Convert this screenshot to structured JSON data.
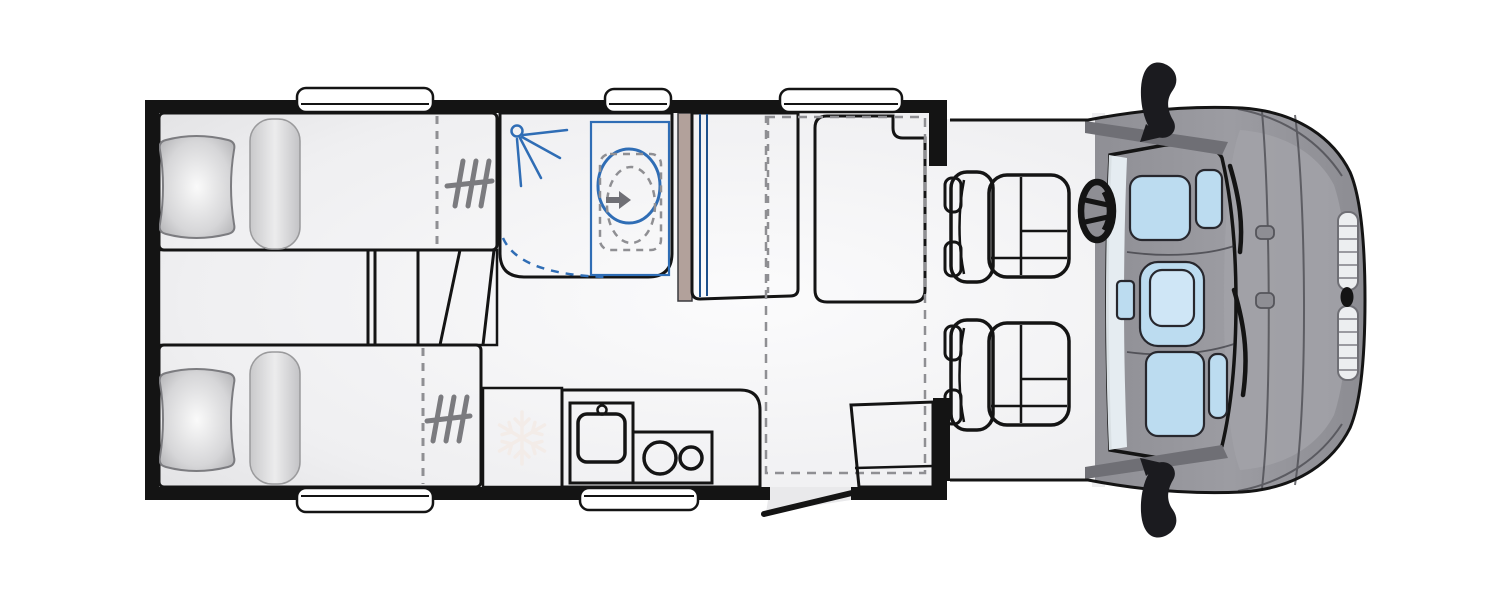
{
  "diagram": {
    "type": "motorhome-floorplan-top-view",
    "features": [
      "rear-twin-bed-top",
      "rear-twin-bed-bottom",
      "pillow",
      "bolster-cushion",
      "bed-steps",
      "bed-extension-dash-line",
      "ladder-icon",
      "shower-room",
      "shower-head-icon",
      "swivel-toilet",
      "toilet-swing-outline",
      "shower-door-swing",
      "wardrobe",
      "rear-bench-seat",
      "drop-down-bed-outline",
      "fridge",
      "snowflake-icon",
      "kitchen-counter",
      "sink",
      "tap",
      "two-burner-hob",
      "entry-door-open",
      "entry-side-seat",
      "driver-swivel-seat",
      "passenger-swivel-seat",
      "steering-wheel-icon",
      "windshield-dashboard",
      "instrument-panel",
      "center-console",
      "wiper-blade-icon",
      "side-mirror-icon",
      "front-grille-icon",
      "brand-badge",
      "window"
    ],
    "window_count": 5,
    "seat_count_cab": 2
  },
  "palette": {
    "bg": "#ffffff",
    "wall": "#141414",
    "line": "#141414",
    "soft_line": "#3a3a3e",
    "floor_hi": "#fbfbfc",
    "floor_lo": "#e0e0e2",
    "mattress_hi": "#f1f1f2",
    "mattress_lo": "#c3c3c6",
    "platform_hi": "#e6e6e8",
    "platform_lo": "#bfbfc3",
    "pillow_hi": "#fafafa",
    "pillow_lo": "#a8a8ab",
    "tan": "#b2a19b",
    "tan_deep": "#a5948e",
    "bath_deep": "#7fbce9",
    "bath_pale": "#eaf5fc",
    "bath_line": "#2f6db5",
    "ward_dark": "#2e6fb2",
    "ward_light": "#82b6e6",
    "seat_dark": "#3f85c9",
    "seat_light": "#7fb2e2",
    "glass_hi": "#ddeefa",
    "glass_lo": "#a9d1ec",
    "dash_item": "#bcdcf0",
    "body_gray": "#97979d",
    "body_hi": "#a6a6ac",
    "body_dark": "#6f6f75",
    "body_line": "#4d4d53",
    "grille": "#eceef0",
    "grille_line": "#9a9aa0",
    "dash_gray": "#8f8f93",
    "icon_gray": "#7b7b7f",
    "snow": "#f3ece8",
    "white": "#ffffff"
  }
}
